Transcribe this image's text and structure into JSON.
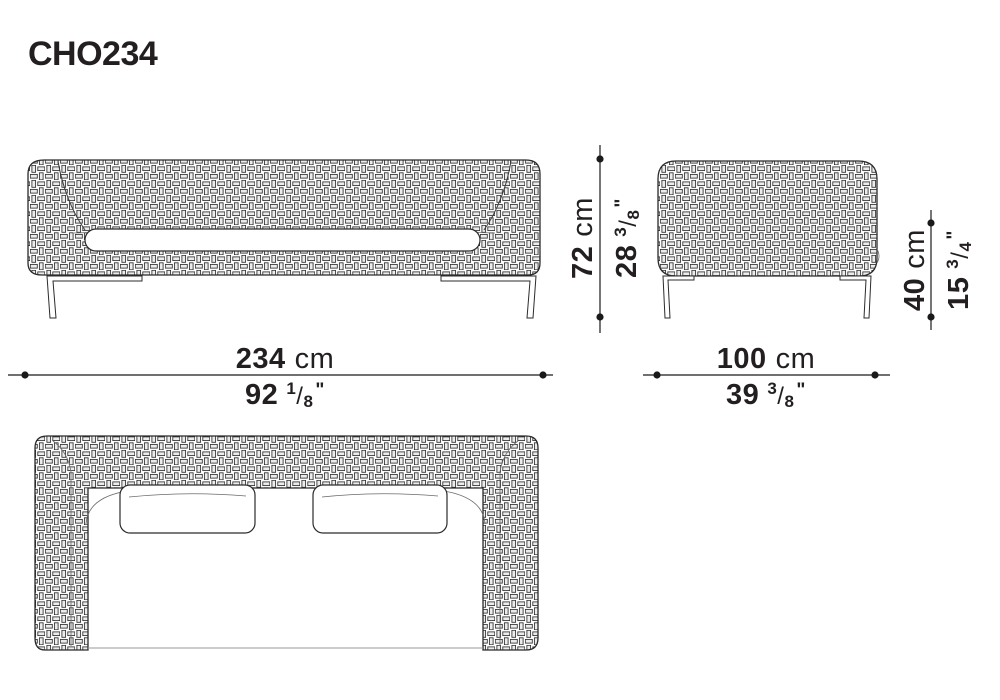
{
  "title": "CHO234",
  "marks": {
    "fraction_slash": "/",
    "inch_mark": "\""
  },
  "dimensions": {
    "front_width": {
      "cm": "234",
      "unit": "cm",
      "inches": "92",
      "frac_num": "1",
      "frac_den": "8"
    },
    "overall_height": {
      "cm": "72",
      "unit": "cm",
      "inches": "28",
      "frac_num": "3",
      "frac_den": "8"
    },
    "side_depth": {
      "cm": "100",
      "unit": "cm",
      "inches": "39",
      "frac_num": "3",
      "frac_den": "8"
    },
    "seat_height": {
      "cm": "40",
      "unit": "cm",
      "inches": "15",
      "frac_num": "3",
      "frac_den": "4"
    }
  }
}
